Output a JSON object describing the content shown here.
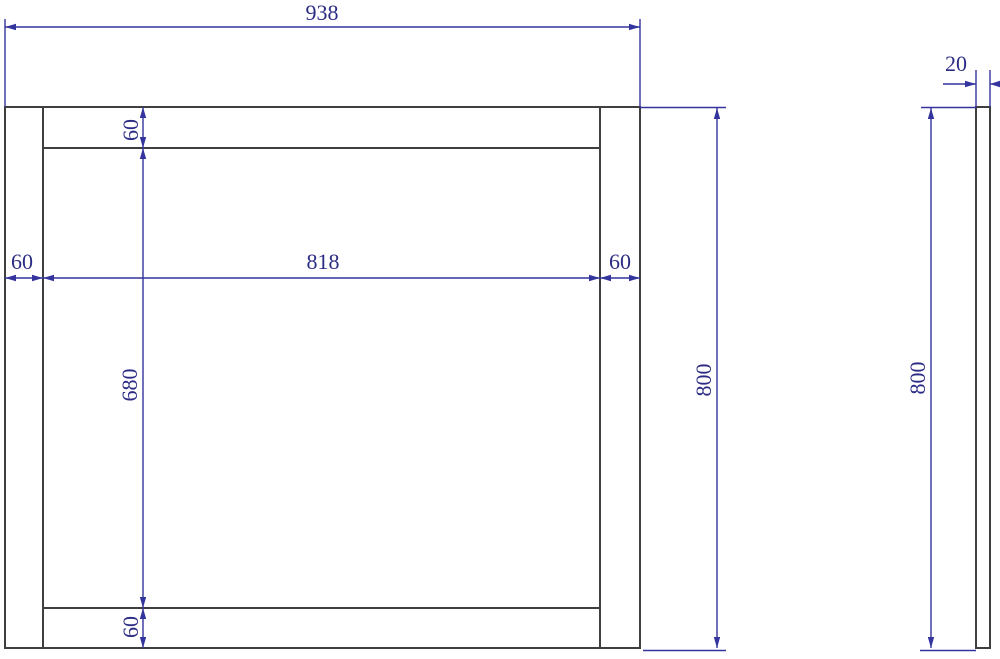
{
  "colors": {
    "object_line": "#3f3f3f",
    "dimension_line": "#34349e",
    "dimension_text": "#2c2c85",
    "background": "#ffffff"
  },
  "front_view": {
    "overall_width": "938",
    "overall_height": "800",
    "opening_width": "818",
    "opening_height": "680",
    "left_stile_width": "60",
    "right_stile_width": "60",
    "top_rail_height": "60",
    "bottom_rail_height": "60"
  },
  "side_view": {
    "thickness": "20",
    "overall_height": "800"
  }
}
